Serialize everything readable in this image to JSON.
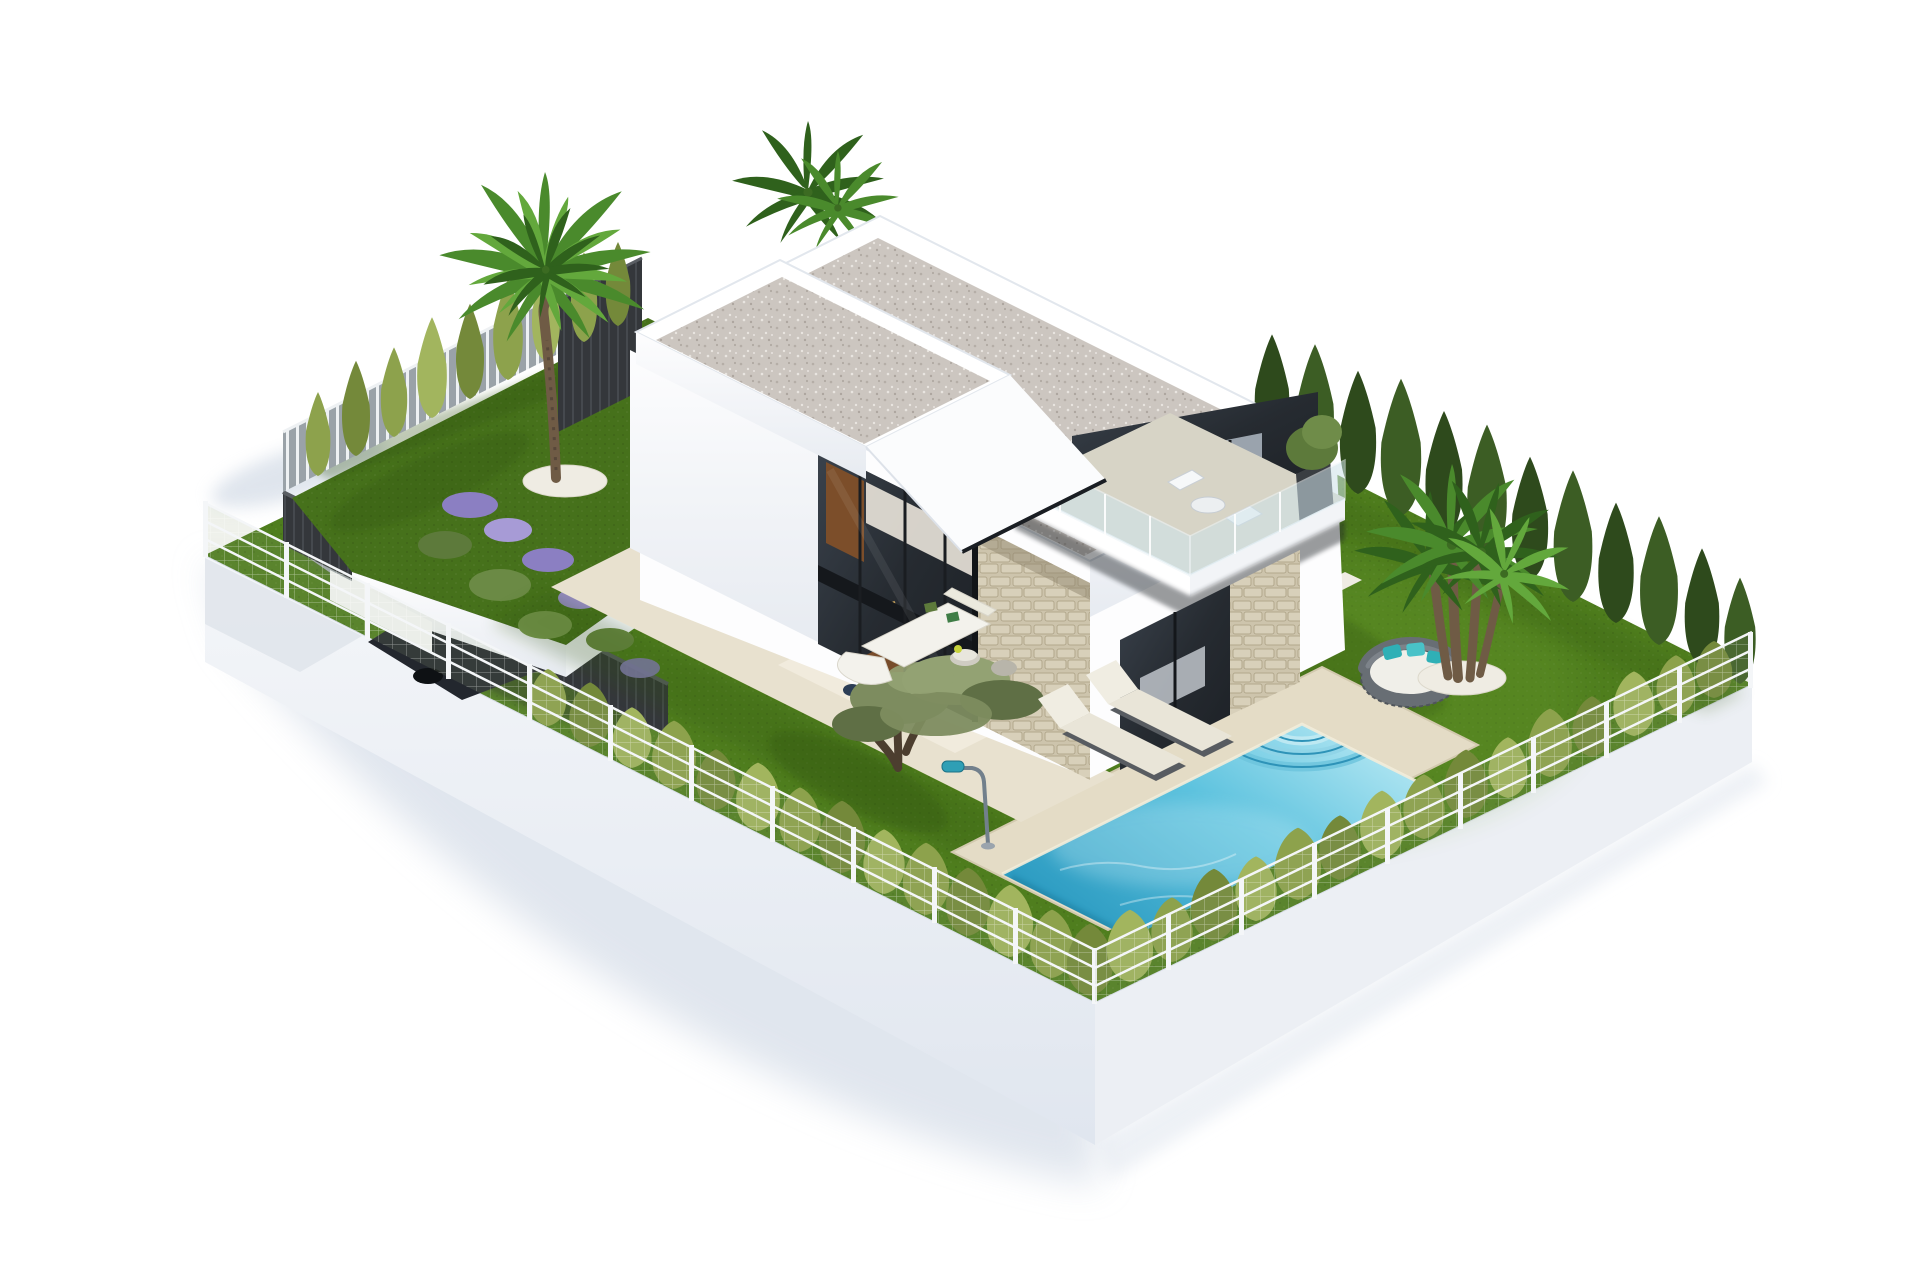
{
  "image": {
    "type": "3d-architectural-render",
    "subject": "Modern two-storey white villa with flat gravel roofs, garden plot, swimming pool and carport",
    "view": "isometric aerial view on plain white background",
    "visible_text": ""
  },
  "palette": {
    "bg": "#ffffff",
    "ground_shadow": "#d9e0ea",
    "platform_left": "#f3f5f9",
    "platform_left_deep": "#e2e8f0",
    "platform_right": "#eceff4",
    "platform_edge": "#d8dee8",
    "grass_main": "#4f7e1e",
    "grass_light": "#5e9026",
    "grass_garden": "#46711b",
    "grass_shadow": "#2f5110",
    "terrace": "#e8e1cf",
    "terrace_light": "#f1ebdd",
    "gravel_white": "#efece3",
    "roof_gravel": "#ccc6c0",
    "wall_white": "#fdfdfe",
    "wall_shade": "#e9edf2",
    "fascia_shade": "#d9dfe6",
    "glass_dark": "#262b31",
    "glass_mid": "#39414b",
    "frame_black": "#1a1d21",
    "wood_warm": "#7c4e2a",
    "interior_warm": "#efe9df",
    "stone": "#cdc4ac",
    "stone_dark": "#b2a78c",
    "stone_light": "#d8d0ba",
    "fence_dark": "#34373b",
    "fence_dark_top": "#53575b",
    "slat_grey": "#9aa2a8",
    "wire_post": "#f4f6f8",
    "wire_mesh": "#95a67c",
    "conifer_light": "#8da24c",
    "conifer_light2": "#a2b55e",
    "conifer_light3": "#74893a",
    "conifer_dark": "#2e4a1c",
    "conifer_dark2": "#3c5d24",
    "palm_green": "#4a8a2c",
    "palm_dark": "#2f611c",
    "palm_light": "#63a83c",
    "palm_trunk": "#6f5b45",
    "olive_green": "#7d8c5f",
    "olive_dark": "#5f6f45",
    "olive_light": "#93a273",
    "olive_trunk": "#4c3e2f",
    "pool_coping": "#e4dcc6",
    "pool_light": "#9fdcec",
    "pool_water": "#45b4d6",
    "pool_deep": "#1f84ac",
    "lounger": "#e9e5d8",
    "lounger_frame": "#585c61",
    "daybed": "#686e74",
    "daybed_cushion": "#f0efe9",
    "pillow_teal": "#2fb0b6",
    "car_body": "#23272e",
    "car_glass": "#41536b",
    "lamp_teal": "#2f9fb5",
    "lamp_pole": "#72808c",
    "flower_purple": "#8b7fc2",
    "flower_green": "#5d7a3b",
    "sofa_white": "#f3f2ec",
    "accent_lime": "#c6d23c"
  },
  "scene": {
    "setting": "Detached building plot raised on a white plinth, surrounded by wire mesh fencing and hedges, rendered floating on a white page",
    "objects": [
      {
        "name": "villa-rear-volume",
        "description": "Large two-storey white volume with flat speckled-gravel roof, upper bedroom with corner balcony, glass balustrade and white outdoor chairs",
        "position": "upper centre-right"
      },
      {
        "name": "villa-front-volume",
        "description": "Smaller front white tower with gravel flat roof, angled cantilever fascia and double-height corner glazing showing kitchen and dining room",
        "position": "upper centre-left"
      },
      {
        "name": "stone-feature-wall",
        "description": "Full-height rustic beige stone-clad pillar between the glazed sections",
        "position": "centre"
      },
      {
        "name": "balcony",
        "description": "First-floor terrace with glass balustrade, two white chairs, small table and a potted plant",
        "position": "right of house"
      },
      {
        "name": "terrace-lounge",
        "description": "Cream paved terrace with white corner sofa, curved bench, round table and green cushions",
        "position": "below house"
      },
      {
        "name": "dining-set",
        "description": "Wooden table with dark blue chairs seen through the corner glazing",
        "position": "inside ground floor"
      },
      {
        "name": "swimming-pool",
        "description": "Rectangular turquoise pool with beige coping and quarter-circle corner steps",
        "position": "lower centre-right"
      },
      {
        "name": "sun-loungers",
        "description": "Two cream sun loungers with dark wicker frames side by side on the lawn",
        "position": "left of pool"
      },
      {
        "name": "round-daybed",
        "description": "Round grey rattan daybed with white cushion and teal pillows",
        "position": "right lawn"
      },
      {
        "name": "palm-left",
        "description": "Tall fan palm on white gravel circle in the raised left garden",
        "position": "left garden"
      },
      {
        "name": "palm-roof",
        "description": "Palm crown peeking above the rear roof parapet",
        "position": "top centre"
      },
      {
        "name": "palm-cluster-right",
        "description": "Multi-trunk fan palm on a white gravel circle",
        "position": "right lawn"
      },
      {
        "name": "olive-tree",
        "description": "Gnarled olive tree with grey-green canopy beside the terrace",
        "position": "centre lawn"
      },
      {
        "name": "carport",
        "description": "Sunken parking bay screened by dark slatted walls containing a dark grey car",
        "position": "lower left"
      },
      {
        "name": "left-garden",
        "description": "Raised lawn with cypress row, lavender and purple flower beds over white retaining walls",
        "position": "left"
      },
      {
        "name": "dark-hedge",
        "description": "Row of tall dark green conifers along the rear right boundary",
        "position": "right"
      },
      {
        "name": "light-hedge",
        "description": "Rows of yellow-green thuja bushes inside the front wire fences",
        "position": "front boundaries"
      },
      {
        "name": "wire-fence",
        "description": "White-posted wire mesh fence on top of the plinth edges",
        "position": "front boundaries"
      },
      {
        "name": "street-lamp",
        "description": "Small teal-headed garden lamp",
        "position": "centre lawn"
      },
      {
        "name": "ground-shadow",
        "description": "Soft blue-grey shadow cast by the plot onto the white ground",
        "position": "lower left"
      }
    ]
  }
}
